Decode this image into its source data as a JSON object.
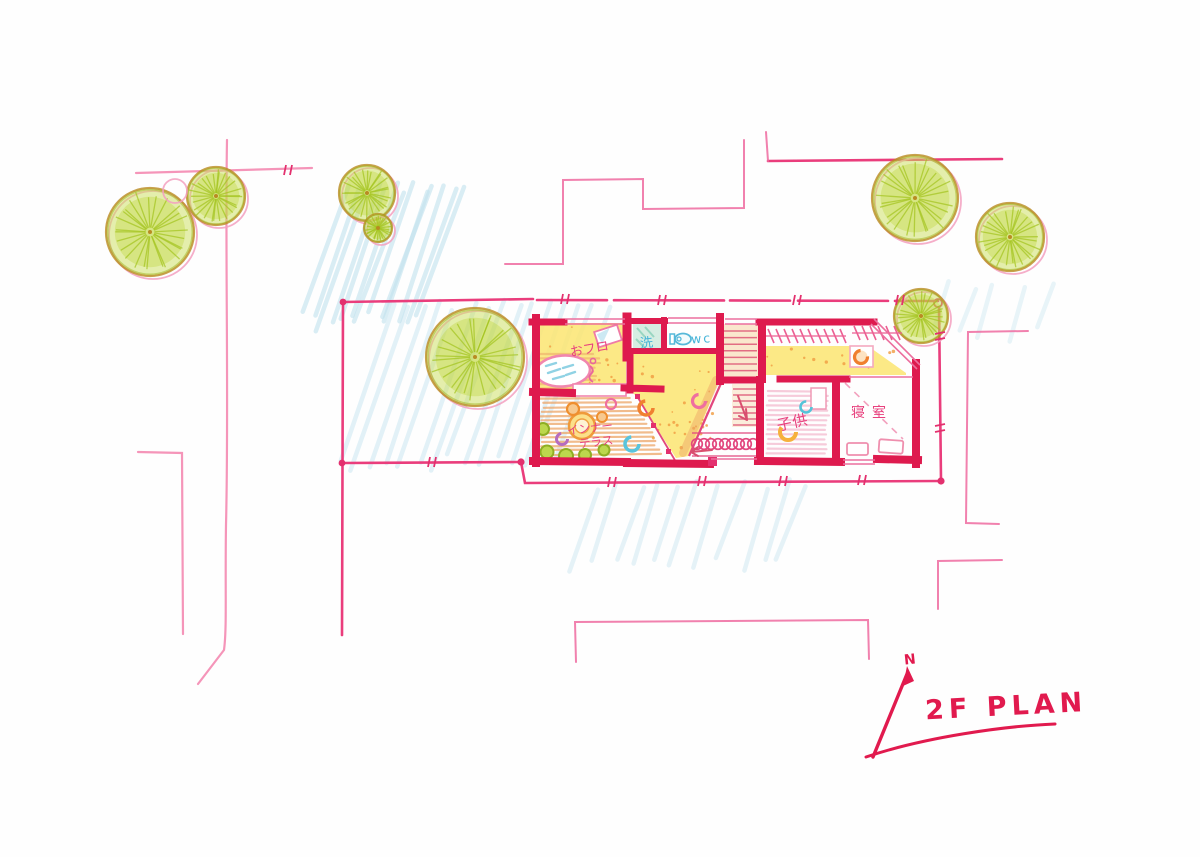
{
  "title": {
    "text": "2F PLAN",
    "north": "N"
  },
  "rooms": {
    "bath": "おフロ",
    "laundry": "洗",
    "wc": "wc",
    "terrace_1": "インナー",
    "terrace_2": "テラス",
    "kids": "子供",
    "bedroom": "寝室"
  },
  "palette": {
    "wall_red": "#de1a4e",
    "site_pink": "#ea3d7c",
    "light_pink": "#f27ba8",
    "label_pink": "#e8417e",
    "label_blue": "#45b4d8",
    "tree_green": "#bcd433",
    "tree_ring": "#b98b22",
    "floor_yellow": "#fbe571",
    "speckle_orange": "#f09b40",
    "wood_orange": "#eda668",
    "kid_pink": "#f6c9d9",
    "hatch_blue": "#c2e2ef",
    "title_red": "#e11a4e"
  },
  "scene": {
    "trees": [
      {
        "cx": 150,
        "cy": 232,
        "r": 44
      },
      {
        "cx": 216,
        "cy": 196,
        "r": 29
      },
      {
        "cx": 172,
        "cy": 188,
        "r": 12,
        "empty": true
      },
      {
        "cx": 367,
        "cy": 193,
        "r": 28
      },
      {
        "cx": 378,
        "cy": 228,
        "r": 14
      },
      {
        "cx": 475,
        "cy": 357,
        "r": 49
      },
      {
        "cx": 915,
        "cy": 198,
        "r": 43
      },
      {
        "cx": 1010,
        "cy": 237,
        "r": 34
      },
      {
        "cx": 921,
        "cy": 316,
        "r": 27
      }
    ],
    "hatches": [
      {
        "x": 300,
        "y": 182,
        "w": 125,
        "h": 140,
        "n": 13,
        "op": 0.6
      },
      {
        "x": 335,
        "y": 300,
        "w": 235,
        "h": 165,
        "n": 15,
        "op": 0.45
      },
      {
        "x": 560,
        "y": 478,
        "w": 235,
        "h": 85,
        "n": 11,
        "op": 0.4
      },
      {
        "x": 925,
        "y": 278,
        "w": 120,
        "h": 55,
        "n": 5,
        "op": 0.35
      }
    ]
  }
}
